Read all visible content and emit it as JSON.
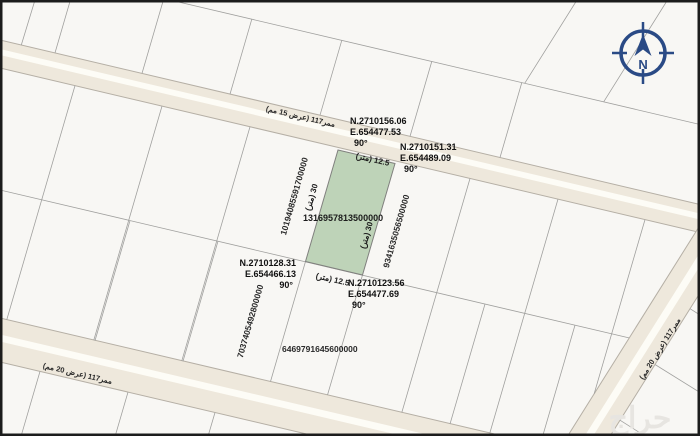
{
  "colors": {
    "map_bg": "#f8f7f4",
    "street_fill": "#eee8dc",
    "street_stripe": "#fdfcf6",
    "street_edge": "#b5afa5",
    "line_gray": "#a0a09e",
    "parcel_green": "#bed3b8",
    "compass_blue": "#2a4a85",
    "text_dark": "#111111",
    "watermark_gray": "#e7e5e1",
    "border_black": "#1c1c1c"
  },
  "map": {
    "compass": {
      "label": "N"
    },
    "watermark": "حراج",
    "streets": {
      "top": {
        "label": "ممر117 (عرض 15 مم)"
      },
      "bottom_left": {
        "label": "ممر117 (عرض 20 مم)"
      },
      "right": {
        "label": "ممر117 (عرض 20 مم)"
      }
    },
    "parcel": {
      "number": "1316957813500000",
      "side_length": "30 (متر)",
      "frontage_length": "12.5 (متر)",
      "corners": {
        "top_left": {
          "n": "N.2710156.06",
          "e": "E.654477.53",
          "angle": "90°"
        },
        "top_right": {
          "n": "N.2710151.31",
          "e": "E.654489.09",
          "angle": "90°"
        },
        "bottom_left": {
          "n": "N.2710128.31",
          "e": "E.654466.13",
          "angle": "90°"
        },
        "bottom_right": {
          "n": "N.2710123.56",
          "e": "E.654477.69",
          "angle": "90°"
        }
      }
    },
    "neighbor_parcels": {
      "west": "10194085591700000",
      "east": "9341635056500000",
      "southwest": "7037405492800000",
      "south": "6469791645600000"
    }
  }
}
